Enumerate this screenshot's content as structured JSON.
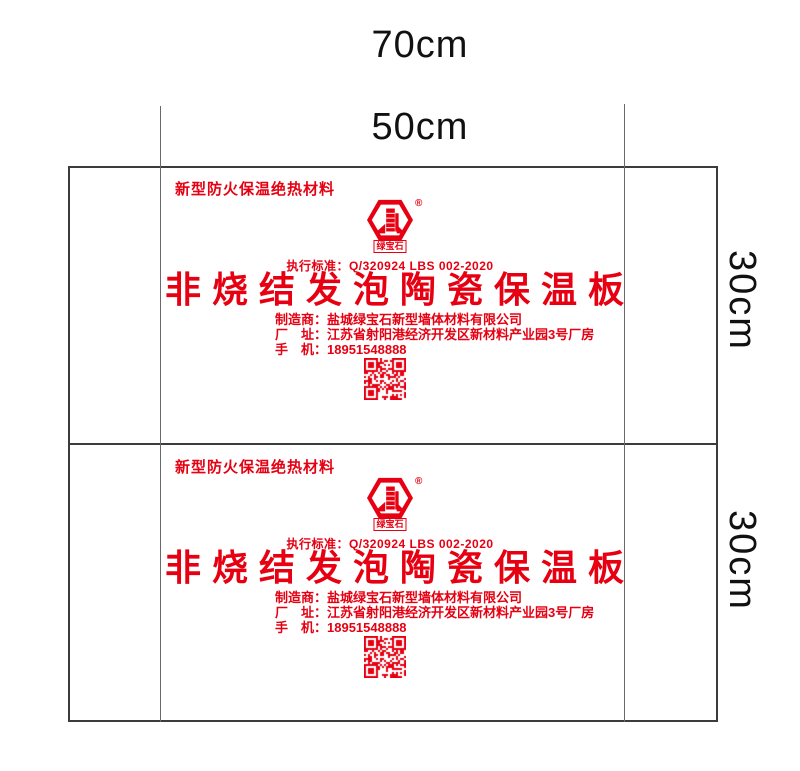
{
  "page": {
    "background": "#ffffff",
    "accent_red": "#e60012",
    "cut_line_color": "#3c3c3c",
    "fold_line_color": "#6a6a6a",
    "dimension_text_color": "#111111"
  },
  "dimension_labels": {
    "outer_width": "70cm",
    "inner_width": "50cm",
    "top_panel_height": "30cm",
    "bottom_panel_height": "30cm"
  },
  "panel": {
    "header": "新型防火保温绝热材料",
    "logo": {
      "registered_mark": "®",
      "wordmark": "绿宝石"
    },
    "standard": "执行标准：Q/320924 LBS 002-2020",
    "title": "非烧结发泡陶瓷保温板",
    "info_lines": [
      "制造商：盐城绿宝石新型墙体材料有限公司",
      "厂　址：江苏省射阳港经济开发区新材料产业园3号厂房",
      "手　机：18951548888"
    ]
  }
}
